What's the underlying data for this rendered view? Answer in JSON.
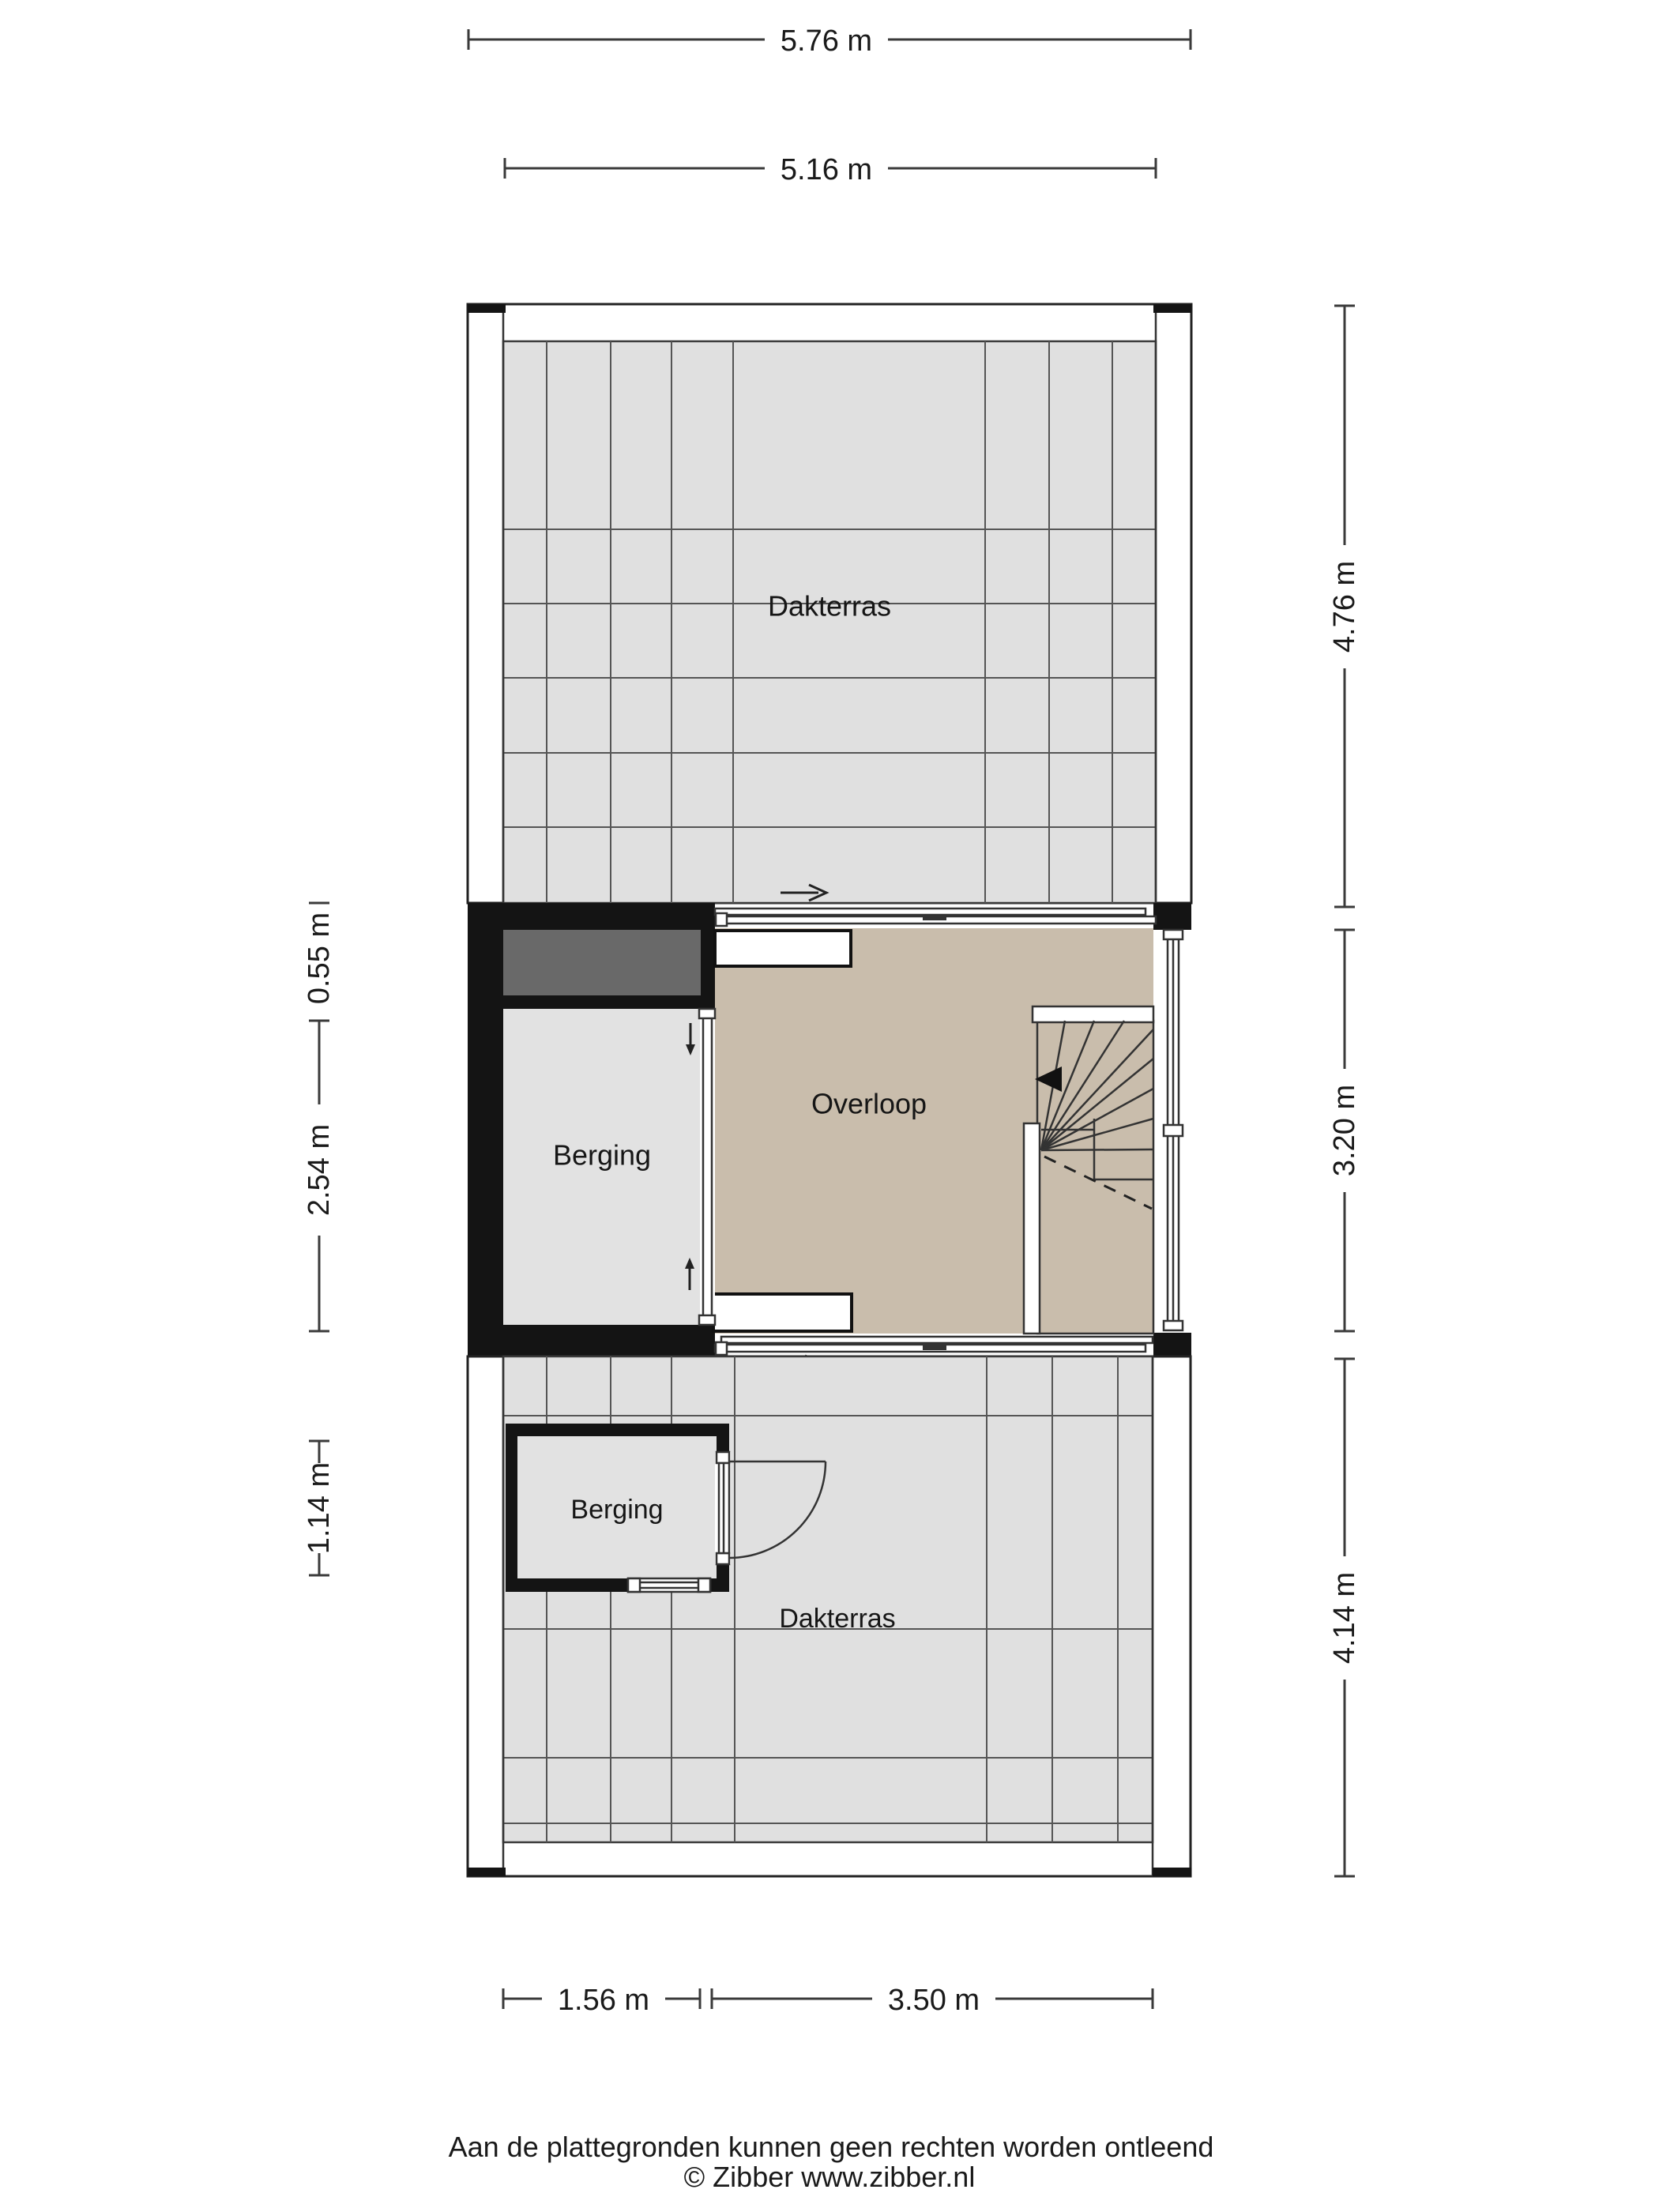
{
  "dimensions": {
    "top_outer": "5.76 m",
    "top_inner": "5.16 m",
    "right_top": "4.76 m",
    "right_middle": "3.20 m",
    "right_bottom": "4.14 m",
    "left_top": "0.55 m",
    "left_middle": "2.54 m",
    "left_bottom": "1.14 m",
    "bottom_left": "1.56 m",
    "bottom_right": "3.50 m"
  },
  "rooms": {
    "dakterras_top": "Dakterras",
    "berging_middle": "Berging",
    "overloop": "Overloop",
    "berging_bottom": "Berging",
    "dakterras_bottom": "Dakterras"
  },
  "icons": {
    "slide_direction_top": "right-arrow",
    "slide_direction_bottom": "right-arrow",
    "partition_slide_down": "down-arrow",
    "partition_slide_up": "up-arrow",
    "stair_direction": "left-arrow"
  },
  "colors": {
    "wall": "#141414",
    "terrace_floor": "#e0e0e0",
    "room_floor": "#e2e2e2",
    "landing_floor": "#c9bdac",
    "void_fill": "#696969",
    "dimension_line": "#3a3a3a"
  },
  "footer": {
    "disclaimer": "Aan de plattegronden kunnen geen rechten worden ontleend",
    "copyright": "© Zibber www.zibber.nl"
  }
}
